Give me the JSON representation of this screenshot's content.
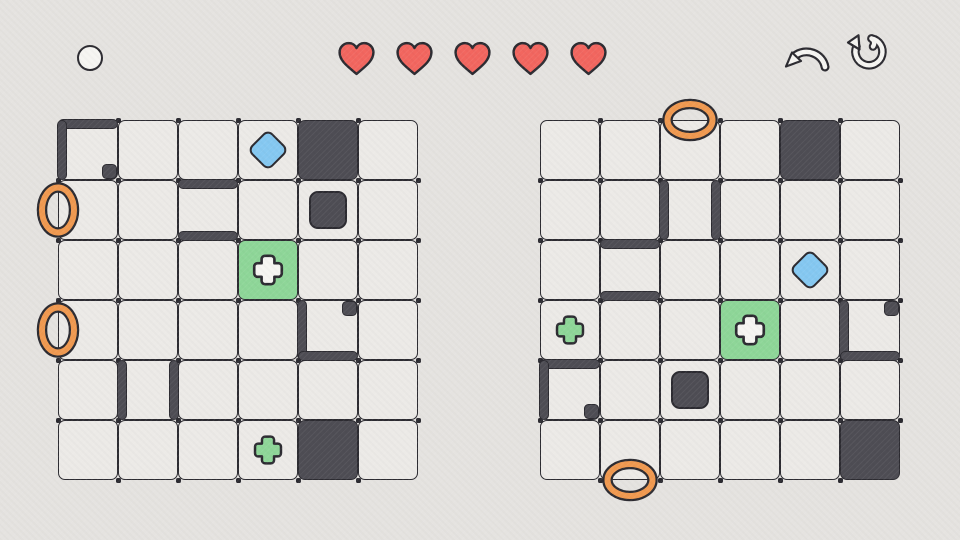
{
  "app": {
    "screen": "dual-grid-puzzle-level"
  },
  "colors": {
    "background": "#e5e3e0",
    "cell": "#eceae7",
    "line": "#2c2b31",
    "dark": "#4e4d54",
    "green": "#8ed698",
    "blue": "#85c8f1",
    "orange": "#f09950",
    "red": "#f2665f",
    "white": "#f6f5f2"
  },
  "hud": {
    "lives": 5,
    "heart_icon": "heart-icon",
    "level_token_icon": "white-circle-icon",
    "undo_icon": "undo-curved-arrow-icon",
    "restart_icon": "restart-circular-arrow-icon"
  },
  "boards": [
    {
      "id": "left",
      "rows": 6,
      "cols": 6,
      "filled_cells": [
        {
          "r": 1,
          "c": 5
        },
        {
          "r": 6,
          "c": 5
        }
      ],
      "blocks": [
        {
          "r": 2,
          "c": 5
        }
      ],
      "diamonds": [
        {
          "r": 1,
          "c": 4
        }
      ],
      "goal_cells": [
        {
          "r": 3,
          "c": 4
        }
      ],
      "plus_pickups": [
        {
          "r": 6,
          "c": 4
        }
      ],
      "rings": [
        {
          "side": "left",
          "r": 2
        },
        {
          "side": "left",
          "r": 4
        }
      ],
      "walls": [
        {
          "r": 1,
          "c": 1,
          "edge": "top"
        },
        {
          "r": 1,
          "c": 1,
          "edge": "left"
        },
        {
          "r": 2,
          "c": 3,
          "edge": "top"
        },
        {
          "r": 2,
          "c": 3,
          "edge": "bottom"
        },
        {
          "r": 4,
          "c": 5,
          "edge": "left"
        },
        {
          "r": 4,
          "c": 5,
          "edge": "bottom"
        },
        {
          "r": 5,
          "c": 2,
          "edge": "left"
        },
        {
          "r": 5,
          "c": 2,
          "edge": "right"
        }
      ],
      "nubs": [
        {
          "r": 1,
          "c": 1,
          "corner": "br"
        },
        {
          "r": 4,
          "c": 5,
          "corner": "tr"
        }
      ]
    },
    {
      "id": "right",
      "rows": 6,
      "cols": 6,
      "filled_cells": [
        {
          "r": 1,
          "c": 5
        },
        {
          "r": 6,
          "c": 6
        }
      ],
      "blocks": [
        {
          "r": 5,
          "c": 3
        }
      ],
      "diamonds": [
        {
          "r": 3,
          "c": 5
        }
      ],
      "goal_cells": [
        {
          "r": 4,
          "c": 4
        }
      ],
      "plus_pickups": [
        {
          "r": 4,
          "c": 1
        }
      ],
      "rings": [
        {
          "side": "top",
          "c": 3
        },
        {
          "side": "bottom",
          "c": 2
        }
      ],
      "walls": [
        {
          "r": 2,
          "c": 3,
          "edge": "left"
        },
        {
          "r": 2,
          "c": 3,
          "edge": "right"
        },
        {
          "r": 3,
          "c": 2,
          "edge": "top"
        },
        {
          "r": 3,
          "c": 2,
          "edge": "bottom"
        },
        {
          "r": 4,
          "c": 6,
          "edge": "left"
        },
        {
          "r": 4,
          "c": 6,
          "edge": "bottom"
        },
        {
          "r": 5,
          "c": 1,
          "edge": "top"
        },
        {
          "r": 5,
          "c": 1,
          "edge": "left"
        }
      ],
      "nubs": [
        {
          "r": 5,
          "c": 1,
          "corner": "br"
        },
        {
          "r": 4,
          "c": 6,
          "corner": "tr"
        }
      ]
    }
  ]
}
